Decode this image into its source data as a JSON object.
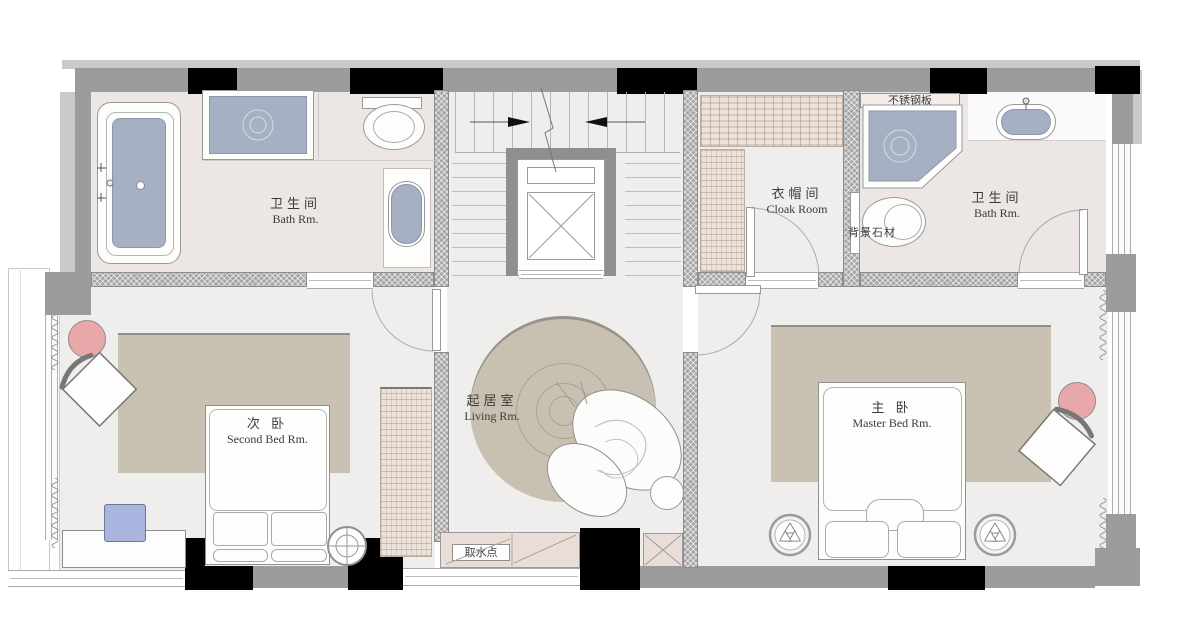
{
  "colors": {
    "wall_gray": "#9c9c9c",
    "column_black": "#000000",
    "floor": "#efeeec",
    "bath_floor": "#ece6e5",
    "fixture_blue": "#a6b0c3",
    "rug_tan": "#c9c2b3",
    "accent_pink": "#e8a8aa",
    "cabinet_beige": "#e9ded7",
    "chair_blue": "#a9b4df"
  },
  "rooms": {
    "bath_left": {
      "zh": "卫生间",
      "en": "Bath Rm."
    },
    "cloak": {
      "zh": "衣帽间",
      "en": "Cloak Room"
    },
    "bath_right": {
      "zh": "卫生间",
      "en": "Bath Rm."
    },
    "second_bed": {
      "zh": "次  卧",
      "en": "Second Bed Rm."
    },
    "living": {
      "zh": "起居室",
      "en": "Living Rm."
    },
    "master_bed": {
      "zh": "主  卧",
      "en": "Master Bed Rm."
    }
  },
  "annotations": {
    "stainless_plate": "不锈钢板",
    "stone_wall": "背景石材",
    "water_point": "取水点"
  }
}
